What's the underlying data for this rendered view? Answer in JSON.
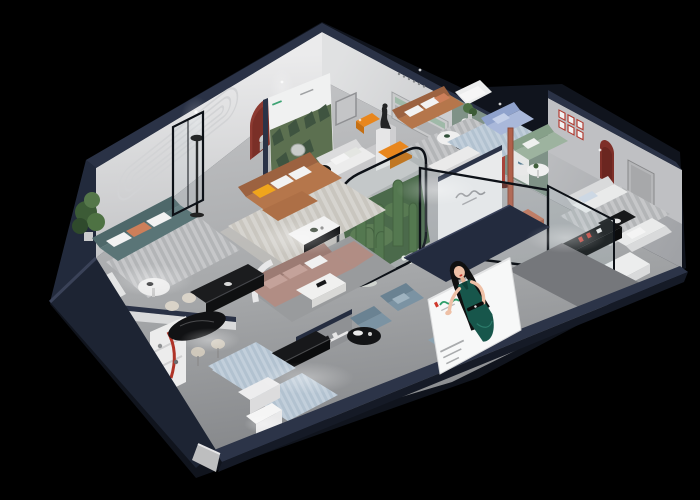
{
  "window": {
    "width": 700,
    "height": 500,
    "background": "#000000"
  },
  "scene": {
    "kind": "isometric cutaway 3D render of a furniture showroom floor plan on black background",
    "palette": {
      "outer_wall_navy": "#2a3246",
      "exterior_navy_dark": "#1b2232",
      "interior_wall_white": "#e2e2e3",
      "floor_gray": "#a8aaac",
      "sage_wall": "#7f9287",
      "teal_sofa": "#5a7577",
      "caramel_sofa": "#b5764b",
      "mauve_sofa": "#b18d84",
      "periwinkle_sofa": "#a9b8da",
      "sage_sofa": "#9db39f",
      "blue_gray_chair": "#7b93a3",
      "accent_orange": "#e8861d",
      "accent_yellow": "#f0a51c",
      "accent_red": "#b03428",
      "plant_green": "#4c7044",
      "billboard_white": "#f7f8f8",
      "billboard_dress_green": "#16544a",
      "billboard_logo_green": "#2f9e6a",
      "billboard_logo_red": "#d0382c"
    },
    "rooms": [
      {
        "id": "lounge-teal",
        "label": "teal sofa lounge",
        "furniture": [
          "3-seat teal sofa with white and orange cushions",
          "white armchair with orange throw",
          "round white coffee table",
          "striped gray rug",
          "tall green plant",
          "grooved feature wall"
        ]
      },
      {
        "id": "dining-nook",
        "label": "dining nook",
        "furniture": [
          "black oval dining table",
          "cream chairs and stools",
          "white niche shelf with red curved lamp",
          "black marble sideboard",
          "blue rug",
          "white side table"
        ]
      },
      {
        "id": "living-caramel",
        "label": "caramel leather living room",
        "furniture": [
          "caramel L-shaped sofa",
          "yellow accent pillow",
          "white coffee table with black base",
          "red arched wall niche with figurine",
          "black floor lamp",
          "framed glass partition",
          "cream rug"
        ]
      },
      {
        "id": "lounge-mauve",
        "label": "dusty-pink corner lounge",
        "furniture": [
          "mauve corner sofa",
          "white marble coffee table",
          "white curved half wall"
        ]
      },
      {
        "id": "gallery",
        "label": "poster gallery corner",
        "furniture": [
          "forest artwork poster wall",
          "dark statue on white pedestal",
          "orange chaise benches",
          "white sofa",
          "round side table with black chair"
        ]
      },
      {
        "id": "sitting-top",
        "label": "upper sitting room",
        "furniture": [
          "caramel sofa with white cushions",
          "nesting coffee tables",
          "recessed wall shelf with green inlay",
          "dotted wall caption",
          "white armchair"
        ]
      },
      {
        "id": "arch-wall",
        "label": "sage arcade wall",
        "furniture": [
          "sage green wall",
          "three white arched niches with small logos",
          "dark red floor lamp"
        ]
      },
      {
        "id": "glass-lounge",
        "label": "glass-walled lounge",
        "furniture": [
          "periwinkle blue sofa",
          "sage green sofa",
          "round white table",
          "blue rug",
          "script logo wall",
          "terracotta bench with white cushions",
          "terracotta floor lamp"
        ]
      },
      {
        "id": "living-right",
        "label": "right white living room",
        "furniture": [
          "two white sofas",
          "dark coffee table",
          "black media console with red decor",
          "six red-framed prints",
          "dark red arched niche",
          "gray door panel",
          "striped rug",
          "white daybed",
          "black tub chair"
        ]
      },
      {
        "id": "front-display",
        "label": "front display aisle",
        "furniture": [
          "blue-gray armchairs",
          "blue-gray ottoman",
          "black round side table",
          "black display benches",
          "white cabinets",
          "picture ledge with small red books",
          "light blue rugs",
          "illuminated white cabinet"
        ]
      },
      {
        "id": "cactus-garden",
        "label": "glass cactus garden",
        "furniture": [
          "rounded glass enclosure with black frame",
          "tall cacti",
          "white blossoms",
          "moss green floor"
        ]
      }
    ],
    "billboard": {
      "background": "#f7f8f8",
      "subject": "illustrated hostess with long black hair in dark green halter dress, one palm extended",
      "logo_colors": [
        "#2f9e6a",
        "#d0382c"
      ],
      "caption_lines": 3,
      "text_legible": false
    },
    "signage_note": "all wall logos and captions are below legible resolution"
  }
}
